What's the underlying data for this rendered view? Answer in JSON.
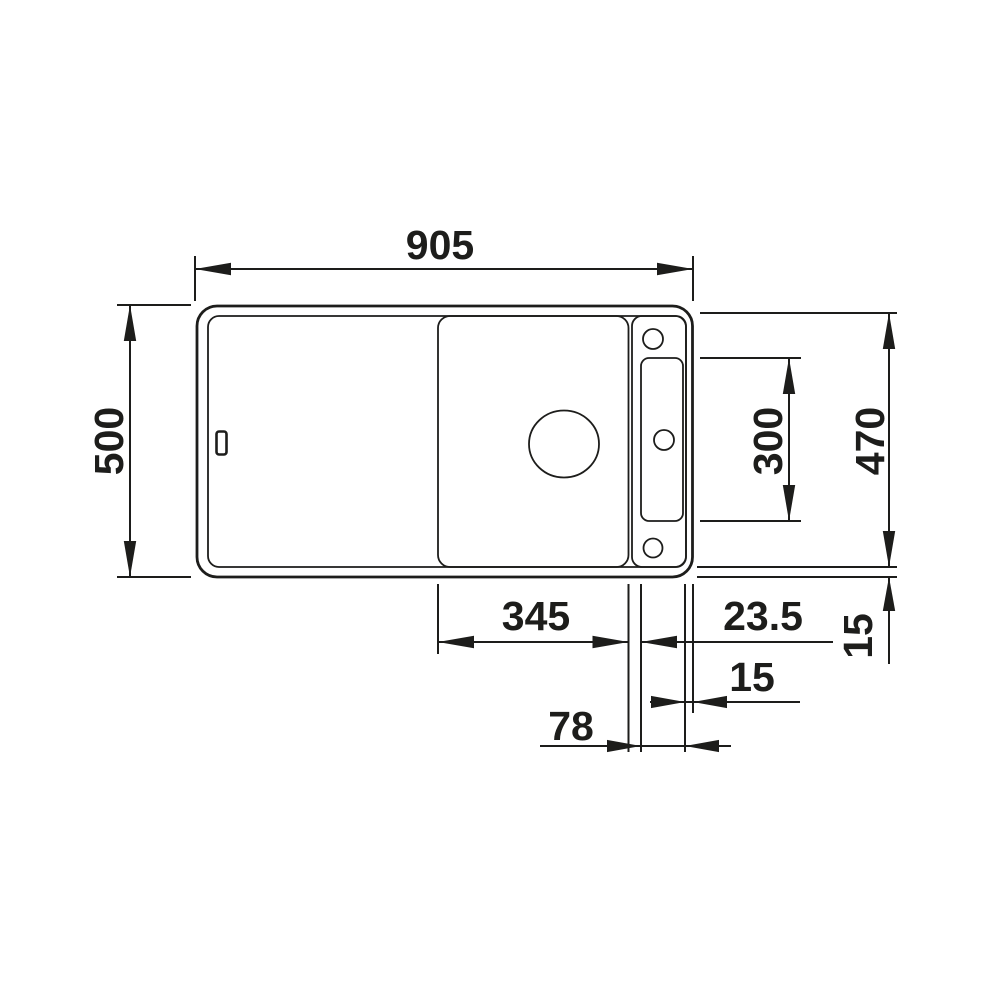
{
  "drawing": {
    "type": "technical-dimension-drawing",
    "subject": "kitchen-sink-top-view",
    "background": "#ffffff",
    "line_color": "#1d1d1b",
    "dimensions": {
      "overall_width": "905",
      "overall_depth": "500",
      "right_depth": "470",
      "tap_panel_height": "300",
      "bowl_width": "345",
      "bowl_to_panel_gap": "23.5",
      "panel_to_edge": "15",
      "tap_panel_width": "78",
      "rim_offset": "15"
    }
  }
}
